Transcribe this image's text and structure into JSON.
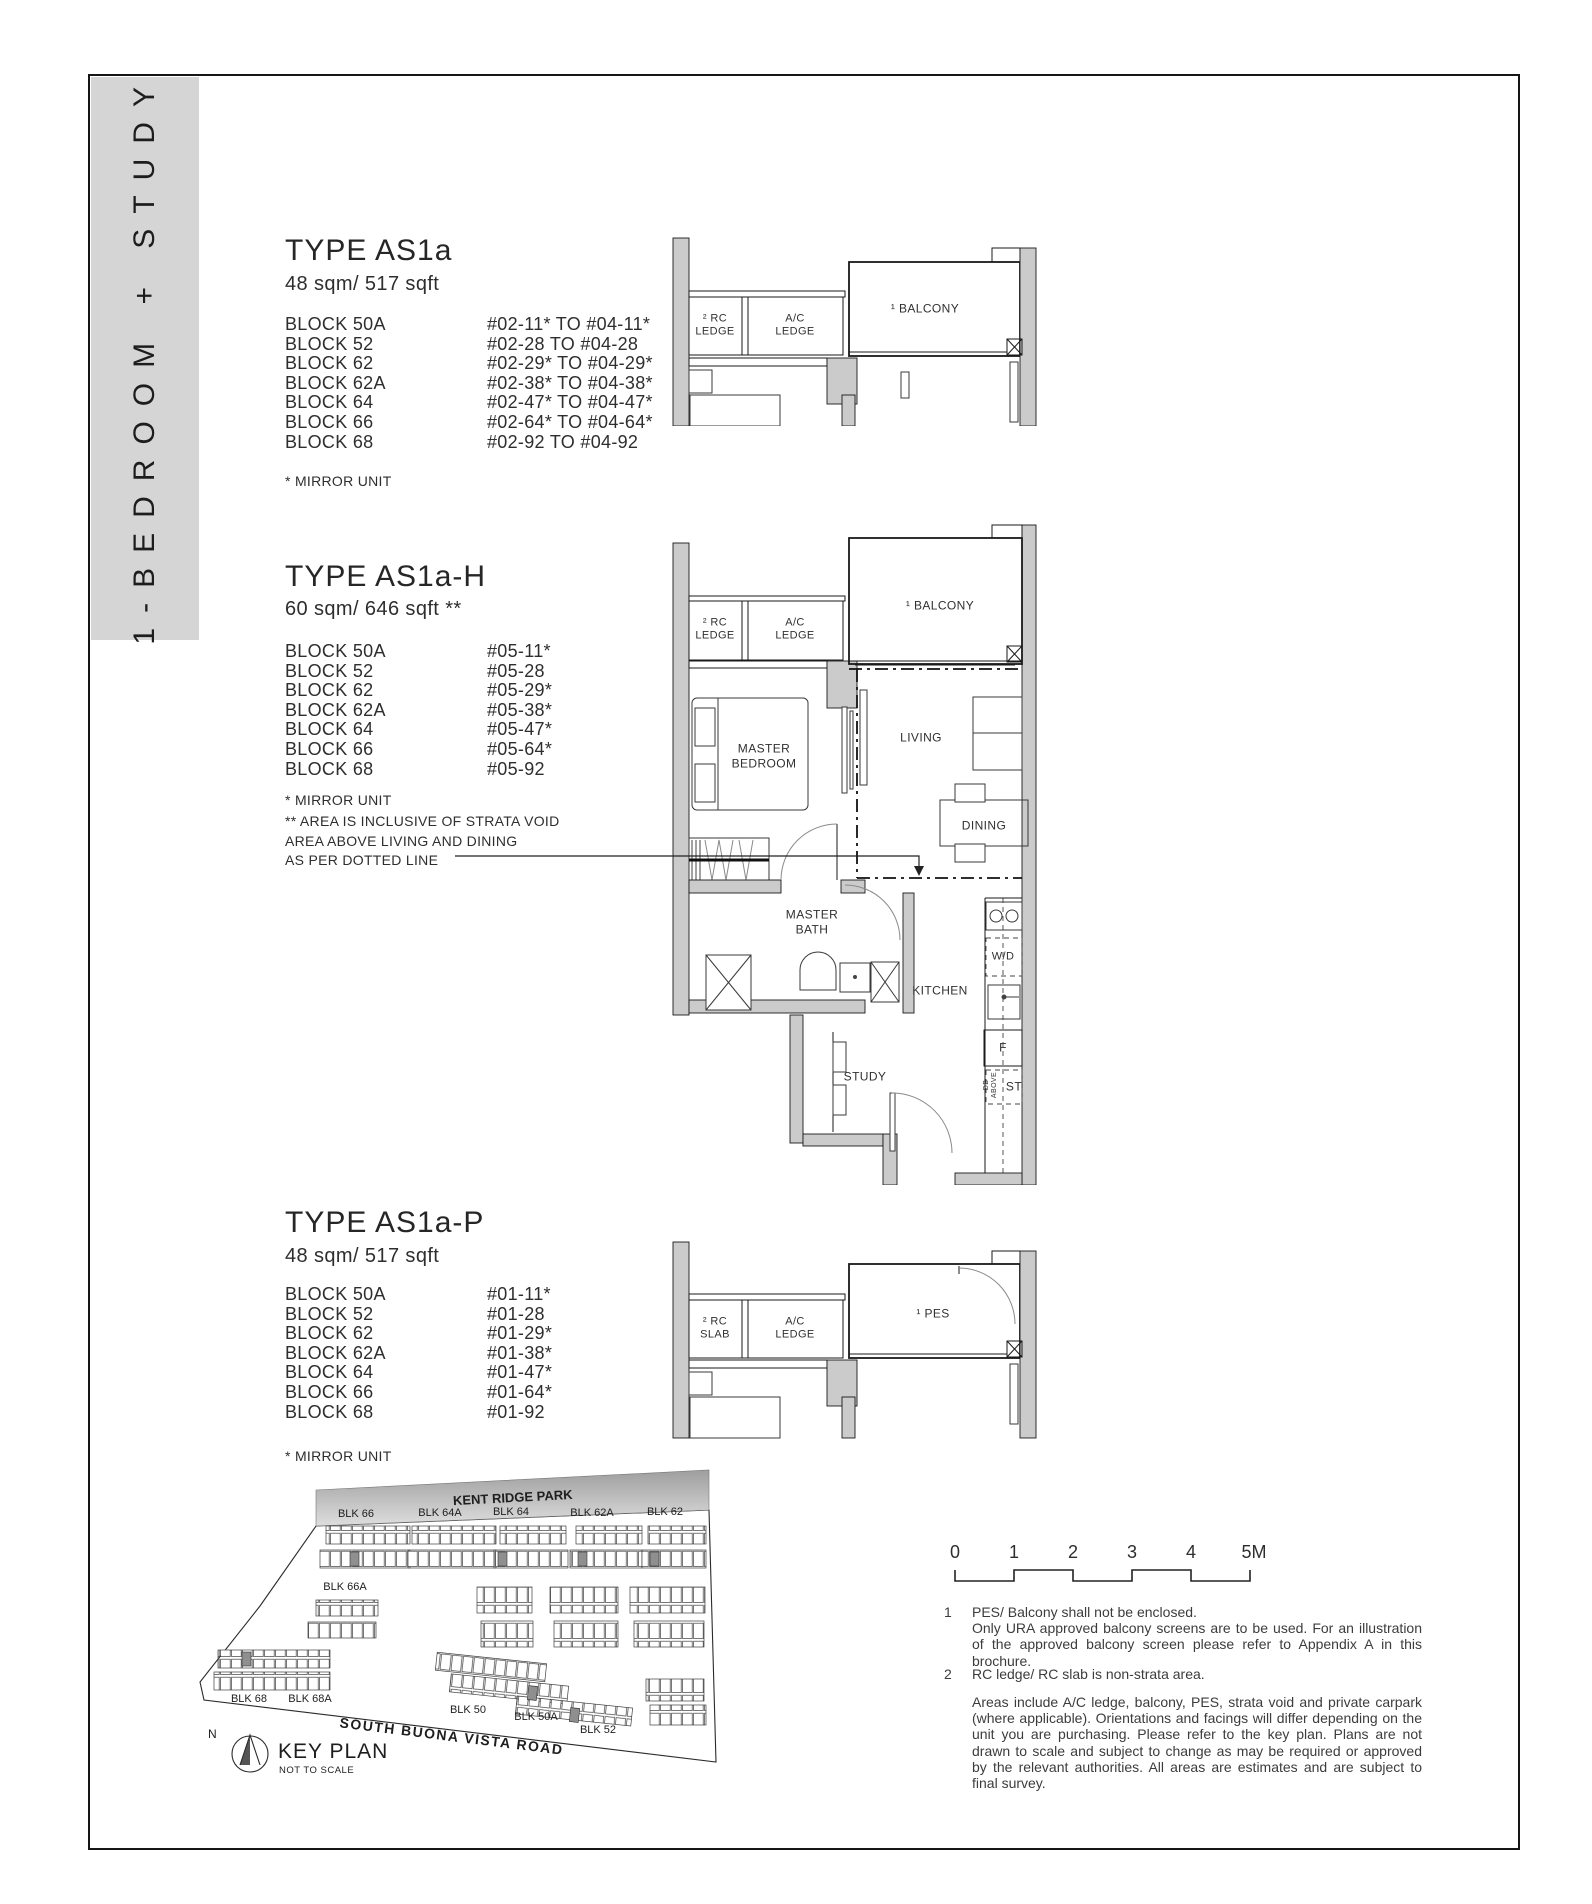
{
  "sidebar": {
    "title": "1-BEDROOM + STUDY"
  },
  "sections": {
    "as1a": {
      "title": "TYPE AS1a",
      "area": "48 sqm/ 517 sqft",
      "rows": [
        {
          "block": "BLOCK 50A",
          "units": "#02-11* TO #04-11*"
        },
        {
          "block": "BLOCK 52",
          "units": "#02-28 TO #04-28"
        },
        {
          "block": "BLOCK 62",
          "units": "#02-29* TO #04-29*"
        },
        {
          "block": "BLOCK 62A",
          "units": "#02-38* TO #04-38*"
        },
        {
          "block": "BLOCK 64",
          "units": "#02-47* TO #04-47*"
        },
        {
          "block": "BLOCK 66",
          "units": "#02-64* TO #04-64*"
        },
        {
          "block": "BLOCK 68",
          "units": "#02-92 TO #04-92"
        }
      ],
      "note": "* MIRROR UNIT"
    },
    "as1a_h": {
      "title": "TYPE AS1a-H",
      "area": "60 sqm/ 646 sqft **",
      "rows": [
        {
          "block": "BLOCK 50A",
          "units": "#05-11*"
        },
        {
          "block": "BLOCK 52",
          "units": "#05-28"
        },
        {
          "block": "BLOCK 62",
          "units": "#05-29*"
        },
        {
          "block": "BLOCK 62A",
          "units": "#05-38*"
        },
        {
          "block": "BLOCK 64",
          "units": "#05-47*"
        },
        {
          "block": "BLOCK 66",
          "units": "#05-64*"
        },
        {
          "block": "BLOCK 68",
          "units": "#05-92"
        }
      ],
      "note": "* MIRROR UNIT",
      "note2": "** AREA IS INCLUSIVE OF STRATA VOID\nAREA ABOVE LIVING AND DINING\nAS PER DOTTED LINE"
    },
    "as1a_p": {
      "title": "TYPE AS1a-P",
      "area": "48 sqm/ 517 sqft",
      "rows": [
        {
          "block": "BLOCK 50A",
          "units": "#01-11*"
        },
        {
          "block": "BLOCK 52",
          "units": "#01-28"
        },
        {
          "block": "BLOCK 62",
          "units": "#01-29*"
        },
        {
          "block": "BLOCK 62A",
          "units": "#01-38*"
        },
        {
          "block": "BLOCK 64",
          "units": "#01-47*"
        },
        {
          "block": "BLOCK 66",
          "units": "#01-64*"
        },
        {
          "block": "BLOCK 68",
          "units": "#01-92"
        }
      ],
      "note": "* MIRROR UNIT"
    }
  },
  "plans": {
    "top": {
      "rc_ledge": "² RC\nLEDGE",
      "ac_ledge": "A/C\nLEDGE",
      "balcony": "¹ BALCONY"
    },
    "main": {
      "rc_ledge": "² RC\nLEDGE",
      "ac_ledge": "A/C\nLEDGE",
      "balcony": "¹ BALCONY",
      "master_bedroom": "MASTER\nBEDROOM",
      "living": "LIVING",
      "dining": "DINING",
      "master_bath": "MASTER\nBATH",
      "kitchen": "KITCHEN",
      "wd": "W/D",
      "f": "F",
      "st": "ST",
      "db_above": "DB\nABOVE",
      "study": "STUDY"
    },
    "ground": {
      "rc_slab": "² RC\nSLAB",
      "ac_ledge": "A/C\nLEDGE",
      "pes": "¹ PES"
    }
  },
  "key_plan": {
    "park": "KENT RIDGE PARK",
    "road": "SOUTH BUONA VISTA ROAD",
    "title": "KEY PLAN",
    "subtitle": "NOT TO SCALE",
    "north": "N",
    "blocks": {
      "blk66": "BLK 66",
      "blk64a": "BLK 64A",
      "blk64": "BLK 64",
      "blk62a": "BLK 62A",
      "blk62": "BLK 62",
      "blk66a": "BLK 66A",
      "blk68": "BLK 68",
      "blk68a": "BLK 68A",
      "blk50": "BLK 50",
      "blk50a": "BLK 50A",
      "blk52": "BLK 52"
    }
  },
  "scale_bar": {
    "ticks": [
      "0",
      "1",
      "2",
      "3",
      "4",
      "5M"
    ]
  },
  "notes": {
    "n1_num": "1",
    "n1": "PES/ Balcony shall not be enclosed.\nOnly URA approved balcony screens are to be used. For an illustration of the approved balcony screen please refer to Appendix A in this brochure.",
    "n2_num": "2",
    "n2": "RC ledge/ RC slab is non-strata area.",
    "n3": "Areas include A/C ledge, balcony, PES, strata void and private carpark (where applicable). Orientations and facings will differ depending on the unit you are purchasing. Please refer to the key plan. Plans are not drawn to scale and subject to change as may be required or approved by the relevant authorities. All areas are estimates and are subject to final survey."
  }
}
